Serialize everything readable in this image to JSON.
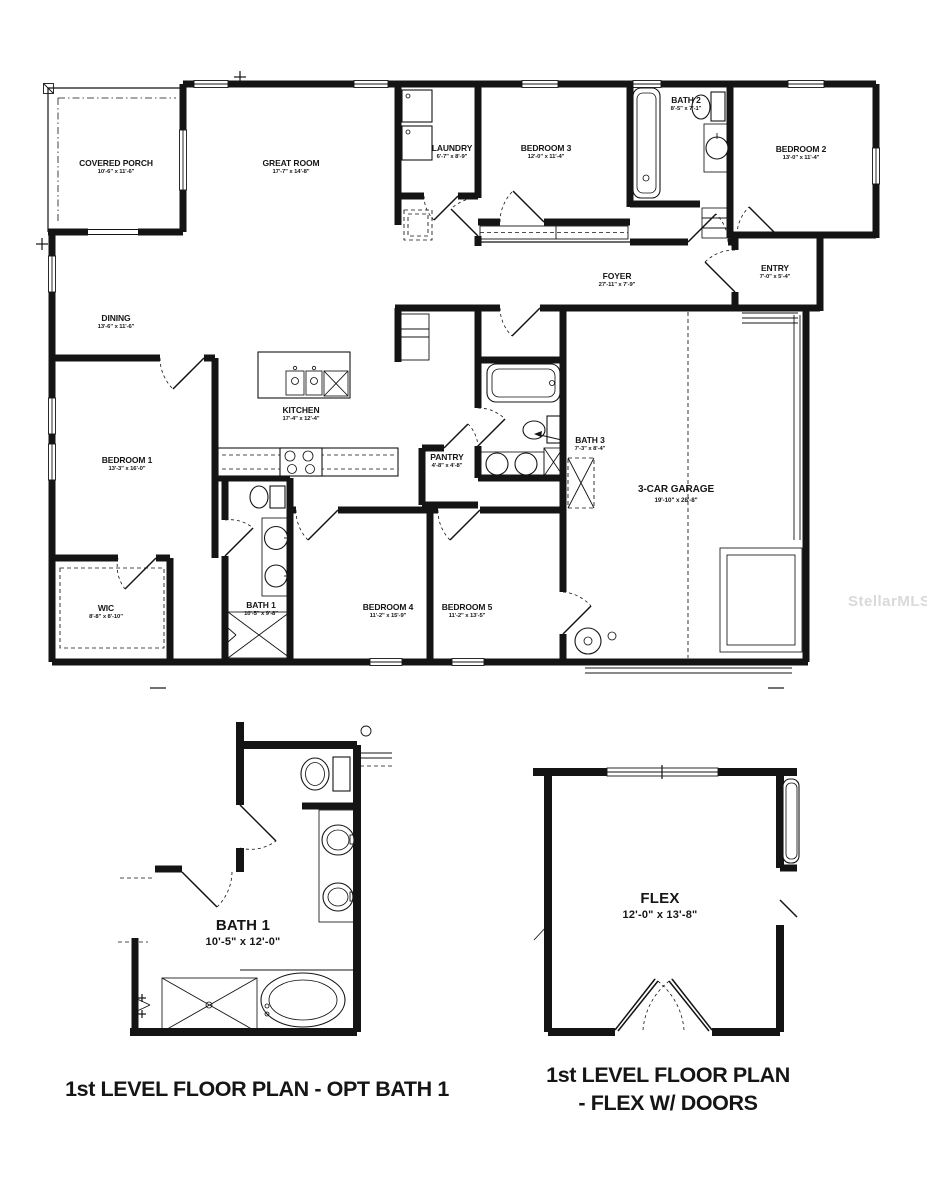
{
  "plan": {
    "rooms": [
      {
        "id": "covered-porch",
        "name": "COVERED PORCH",
        "dims": "10'-6\" x 11'-6\""
      },
      {
        "id": "great-room",
        "name": "GREAT ROOM",
        "dims": "17'-7\" x 14'-8\""
      },
      {
        "id": "laundry",
        "name": "LAUNDRY",
        "dims": "6'-7\" x 8'-9\""
      },
      {
        "id": "bedroom-3",
        "name": "BEDROOM 3",
        "dims": "12'-0\" x 11'-4\""
      },
      {
        "id": "bath-2",
        "name": "BATH 2",
        "dims": "8'-5\" x 7'-1\""
      },
      {
        "id": "bedroom-2",
        "name": "BEDROOM 2",
        "dims": "13'-0\" x 11'-4\""
      },
      {
        "id": "foyer",
        "name": "FOYER",
        "dims": "27'-11\" x 7'-9\""
      },
      {
        "id": "entry",
        "name": "ENTRY",
        "dims": "7'-0\" x 5'-4\""
      },
      {
        "id": "dining",
        "name": "DINING",
        "dims": "13'-6\" x 11'-6\""
      },
      {
        "id": "kitchen",
        "name": "KITCHEN",
        "dims": "17'-4\" x 12'-4\""
      },
      {
        "id": "bedroom-1",
        "name": "BEDROOM 1",
        "dims": "13'-3\" x 16'-0\""
      },
      {
        "id": "pantry",
        "name": "PANTRY",
        "dims": "4'-8\" x 4'-8\""
      },
      {
        "id": "bath-3",
        "name": "BATH 3",
        "dims": "7'-3\" x 8'-4\""
      },
      {
        "id": "garage",
        "name": "3-CAR GARAGE",
        "dims": "19'-10\" x 28'-8\""
      },
      {
        "id": "wic",
        "name": "WIC",
        "dims": "8'-8\" x 8'-10\""
      },
      {
        "id": "bath-1",
        "name": "BATH 1",
        "dims": "10'-5\" x 9'-8\""
      },
      {
        "id": "bedroom-4",
        "name": "BEDROOM 4",
        "dims": "11'-2\" x 15'-9\""
      },
      {
        "id": "bedroom-5",
        "name": "BEDROOM 5",
        "dims": "11'-2\" x 13'-5\""
      }
    ],
    "details": [
      {
        "id": "opt-bath-1",
        "name": "BATH 1",
        "dims": "10'-5\" x 12'-0\"",
        "caption": "1st LEVEL FLOOR PLAN - OPT BATH 1"
      },
      {
        "id": "flex-w-doors",
        "name": "FLEX",
        "dims": "12'-0\" x 13'-8\"",
        "caption_line_1": "1st LEVEL FLOOR PLAN",
        "caption_line_2": "- FLEX W/ DOORS"
      }
    ],
    "watermark": "StellarMLS",
    "colors": {
      "walls": "#141414",
      "background": "#ffffff",
      "watermark": "#d9d9d9"
    }
  }
}
